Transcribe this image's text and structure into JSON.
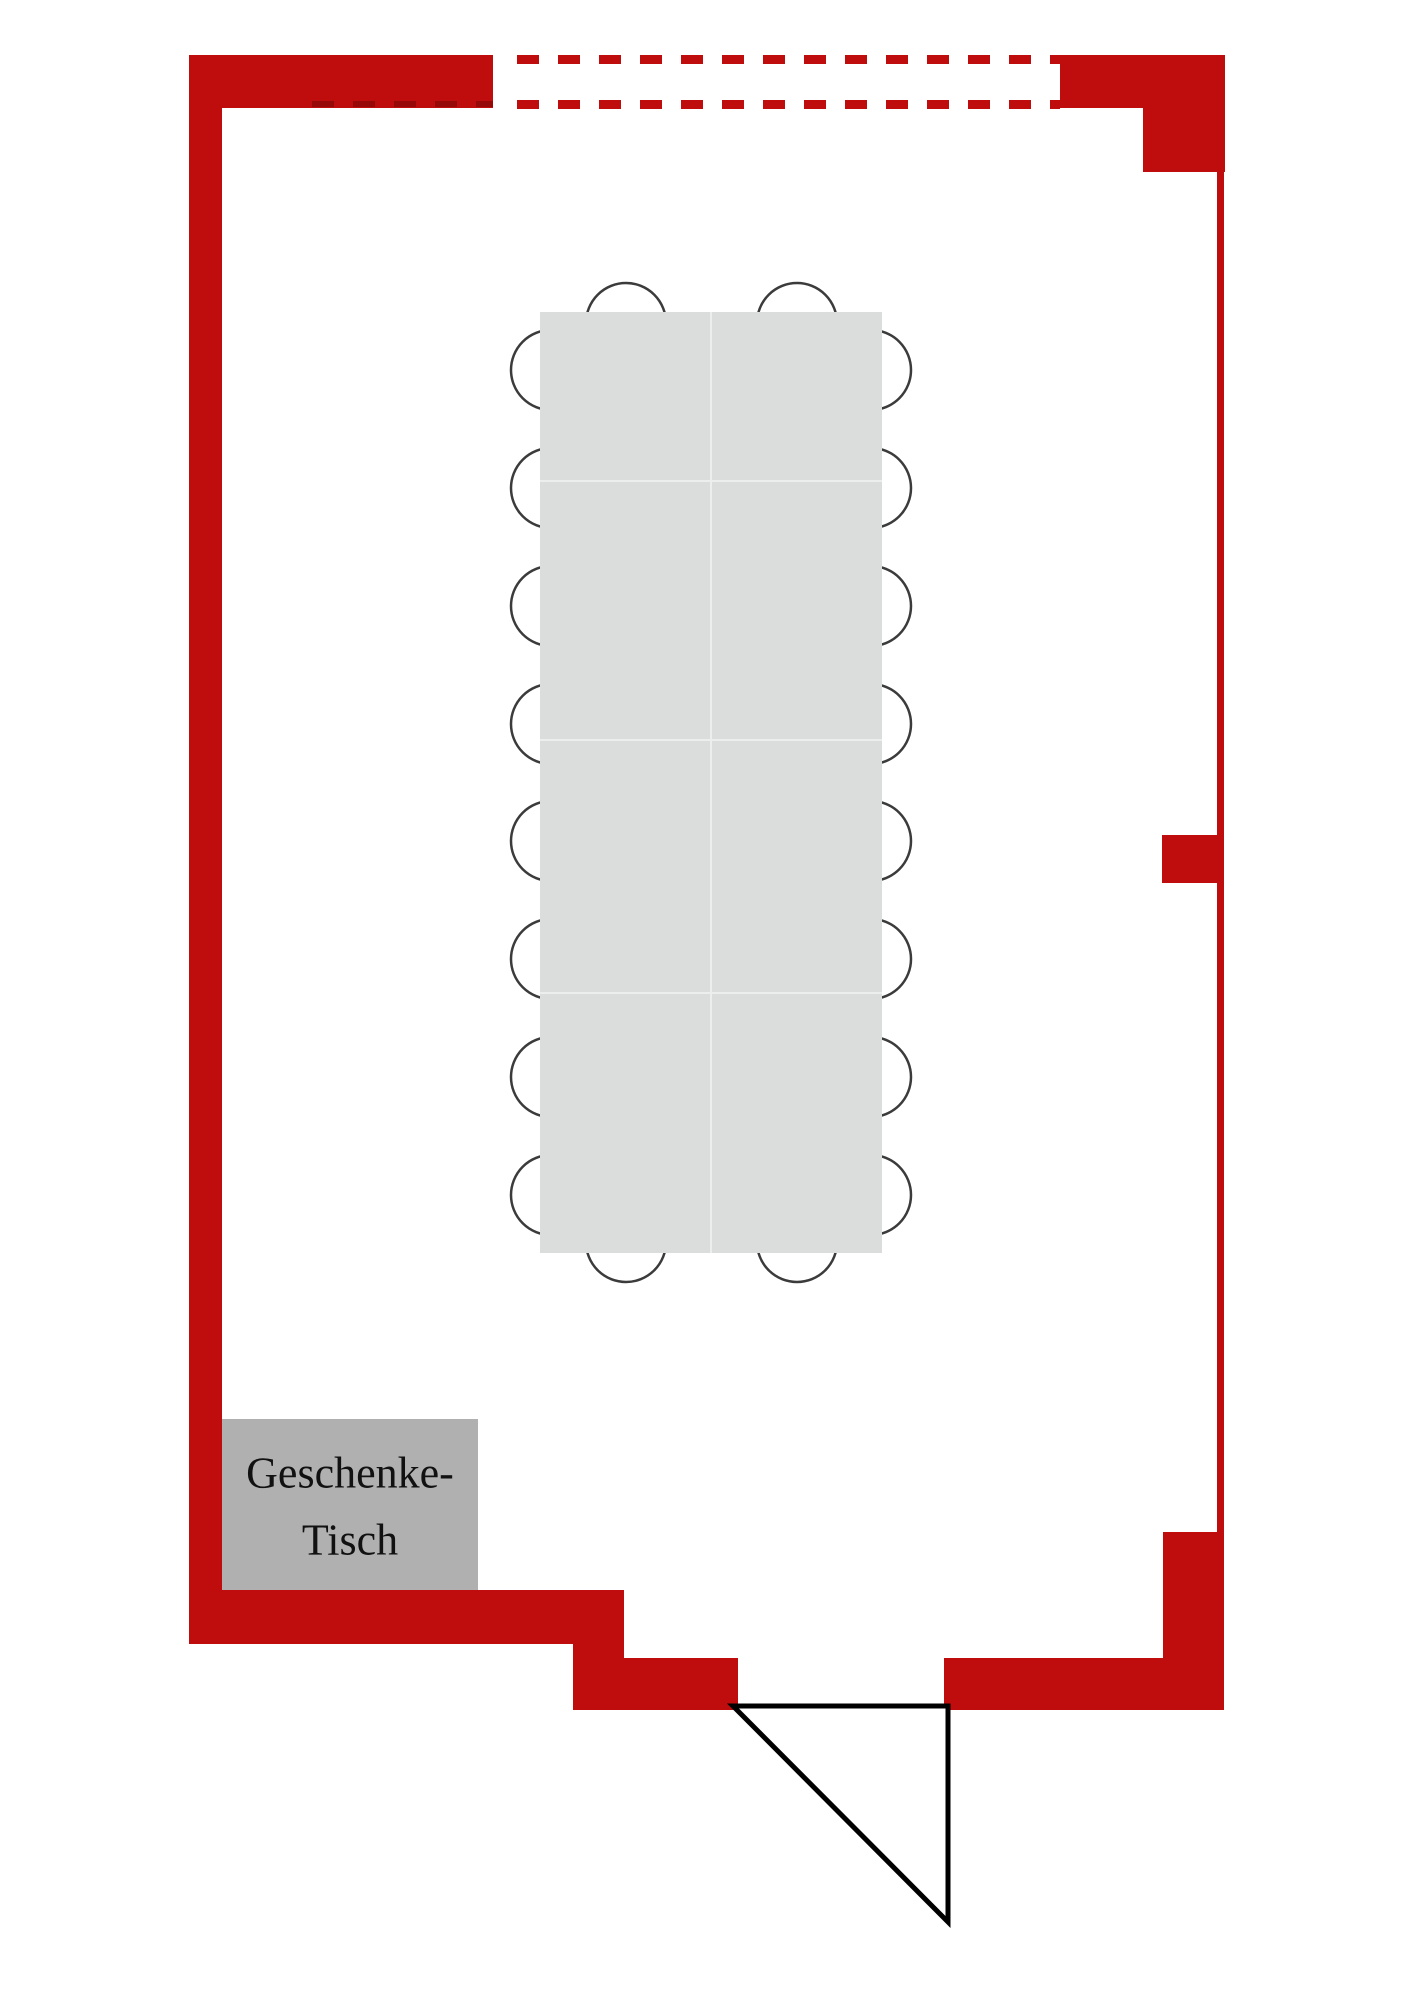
{
  "page": {
    "background": "#ffffff"
  },
  "floorplan": {
    "kind": "room-seating-plan",
    "colors": {
      "wall": "#bf0c0c",
      "wall_dash_overlap": "#8f0808",
      "dining_table_fill": "#dbdcdc",
      "dining_table_grid": "#eceeee",
      "gift_table_fill": "#b0b0b0",
      "chair_stroke": "#3b3b3b",
      "door_stroke": "#000000",
      "label_color": "#111111"
    },
    "dining_table": {
      "grid_columns": 2,
      "grid_rows": 4,
      "chairs_left": 8,
      "chairs_right": 8,
      "chairs_top": 2,
      "chairs_bottom": 2,
      "chairs_total": 20
    },
    "gift_table": {
      "label_line1": "Geschenke-",
      "label_line2": "Tisch"
    },
    "openings": {
      "top_window": "dashed",
      "bottom_door": "swing-triangle"
    }
  }
}
